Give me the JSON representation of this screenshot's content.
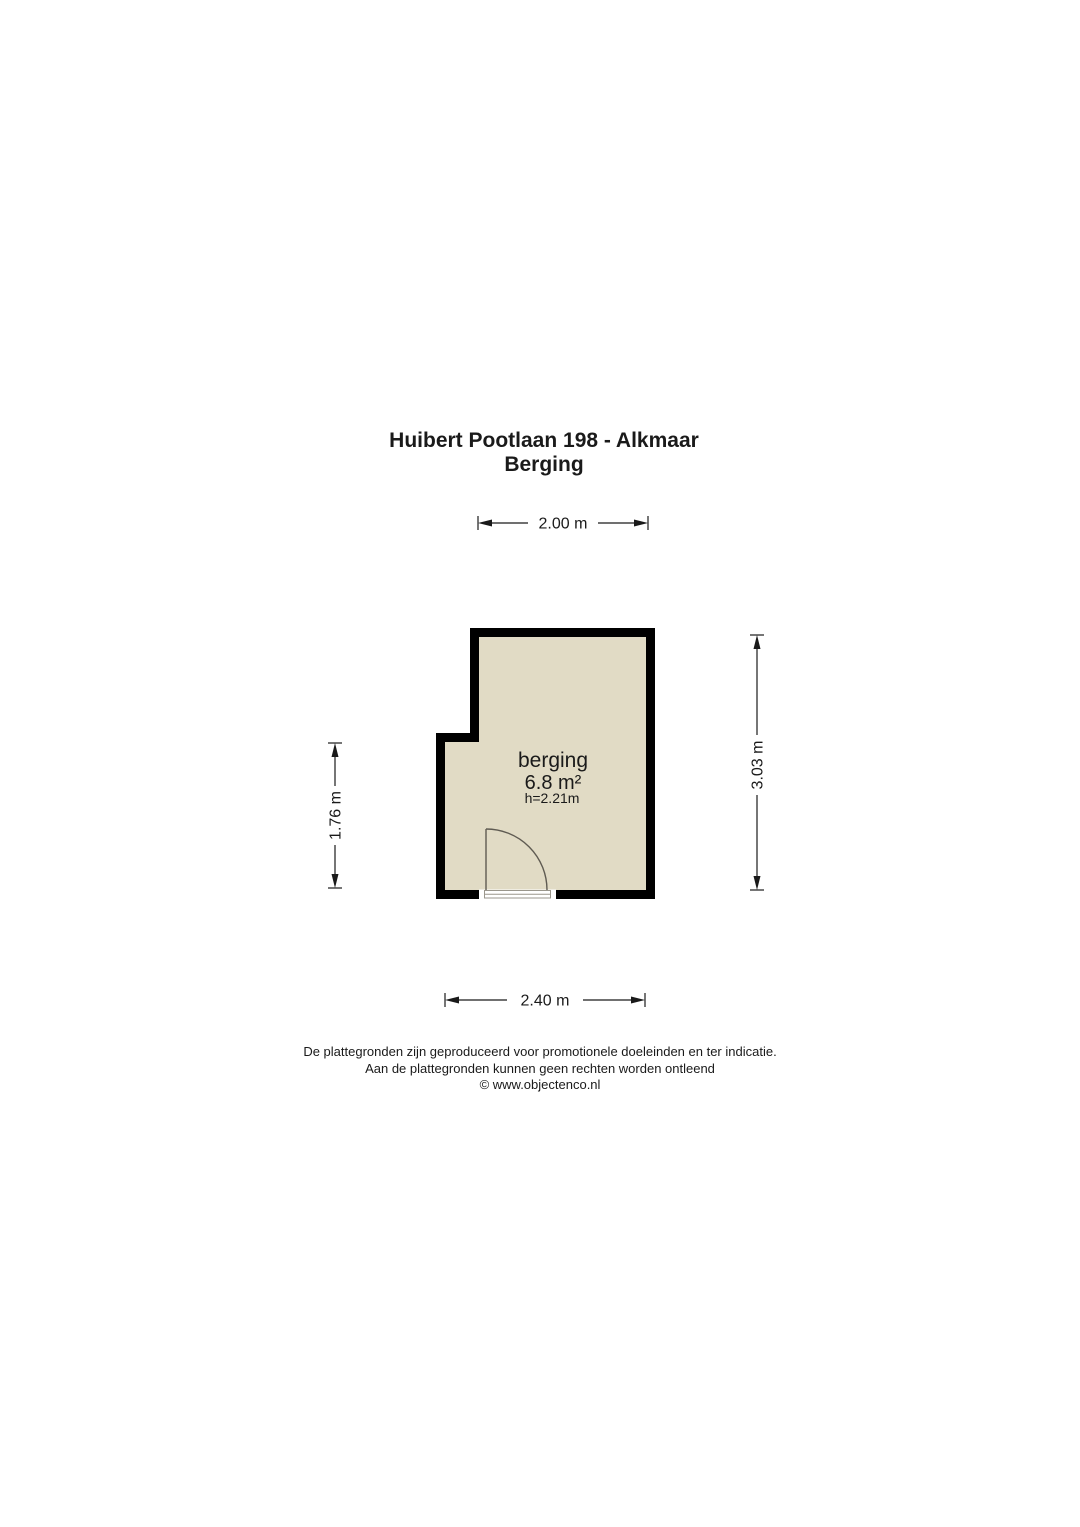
{
  "title": {
    "address": "Huibert Pootlaan 198 - Alkmaar",
    "floor": "Berging"
  },
  "room": {
    "name": "berging",
    "area": "6.8 m²",
    "ceiling_height": "h=2.21m"
  },
  "dimensions": {
    "top_width": "2.00 m",
    "bottom_width": "2.40 m",
    "left_height": "1.76 m",
    "right_height": "3.03 m"
  },
  "colors": {
    "wall": "#000000",
    "floor_fill": "#e1dbc5",
    "door_line": "#5f5b52",
    "threshold_line": "#9a968c"
  },
  "footer": {
    "disclaimer_line1": "De plattegronden zijn geproduceerd voor promotionele doeleinden en ter indicatie.",
    "disclaimer_line2": "Aan de plattegronden kunnen geen rechten worden ontleend",
    "credit": "© www.objectenco.nl"
  }
}
